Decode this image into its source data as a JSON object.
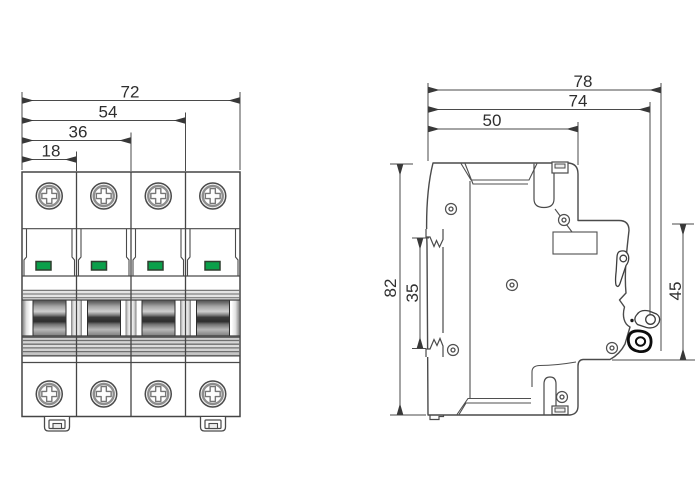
{
  "drawing": {
    "views": {
      "front": {
        "label": "front-view-4-pole-breaker",
        "dims": {
          "total_width": "72",
          "three_modules": "54",
          "two_modules": "36",
          "one_module": "18"
        },
        "pole_count": 4
      },
      "side": {
        "label": "side-view",
        "dims": {
          "total_depth": "78",
          "handle_face_depth": "74",
          "base_depth": "50",
          "total_height": "82",
          "din_slot_height": "35",
          "front_section_height": "45"
        }
      }
    },
    "colors": {
      "line": "#4c4c4c",
      "dimension_text": "#2e2e2e",
      "indicator_green": "#0aa04a"
    }
  }
}
